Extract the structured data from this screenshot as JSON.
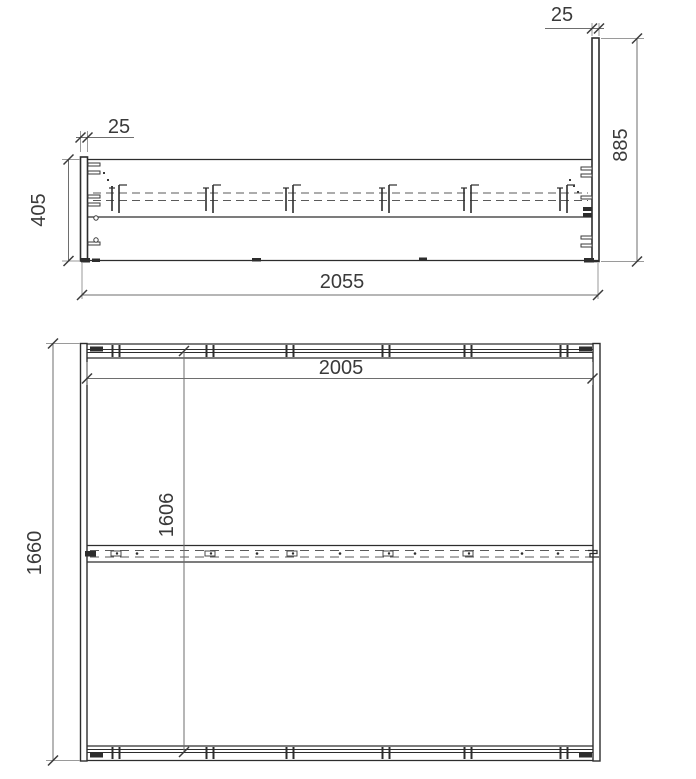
{
  "side_view": {
    "footboard_thickness": "25",
    "headboard_thickness": "25",
    "headboard_height": "885",
    "frame_height": "405",
    "overall_length": "2055"
  },
  "plan_view": {
    "inner_length": "2005",
    "slat_span": "1606",
    "overall_width": "1660"
  },
  "colors": {
    "structure_line": "#2d2d2d",
    "hidden_line": "#5a5a5a",
    "dimension_line": "#6e6e6e",
    "extension_line": "#9a9a9a",
    "text": "#3a3a3a",
    "background": "#ffffff"
  }
}
